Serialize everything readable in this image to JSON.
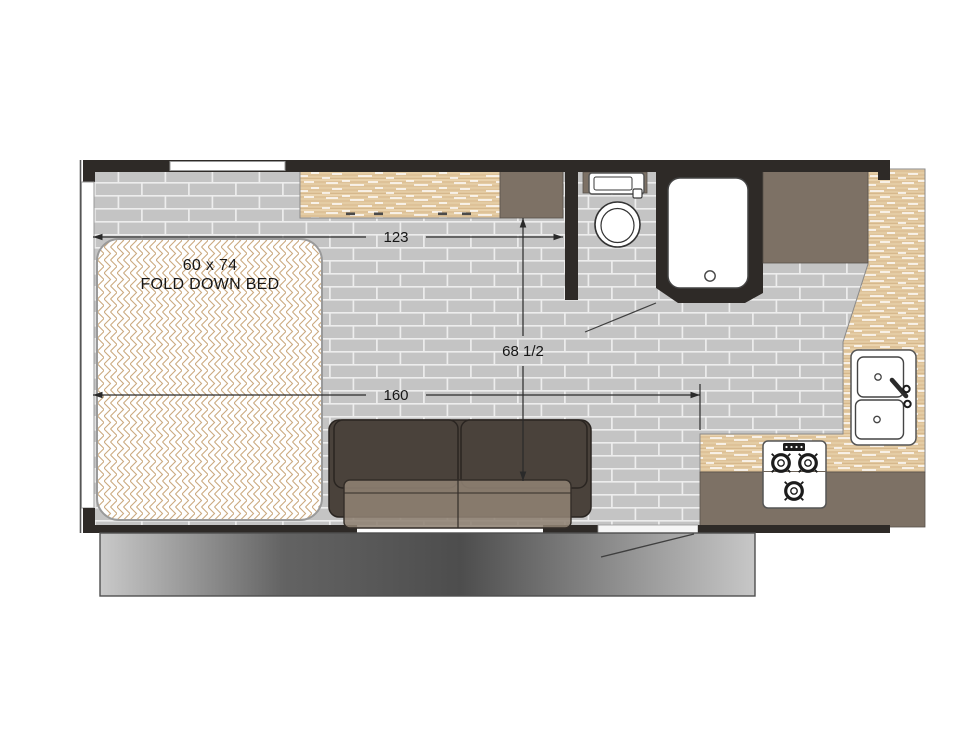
{
  "plan_title": "travel trailer floor plan",
  "bed": {
    "line1": "60 x 74",
    "line2": "FOLD DOWN BED"
  },
  "dimensions": {
    "front_section": "123",
    "interior_height": "68 1/2",
    "main_length": "160"
  },
  "colors": {
    "wall": "#2e2a27",
    "cabinet": "#7d7165",
    "sofa": "#4a423b",
    "sofa_seat": "#8f8273",
    "counter_wood": "#ead3ad",
    "wood_grain": "#d6b88c",
    "floor_tile": "#c4c4c4",
    "tile_grout": "#ededed",
    "bed_pattern": "#cbaa80",
    "dimension": "#2a2a2a",
    "slideout_dark": "#4d4d4d",
    "slideout_light": "#c9c9c9"
  }
}
